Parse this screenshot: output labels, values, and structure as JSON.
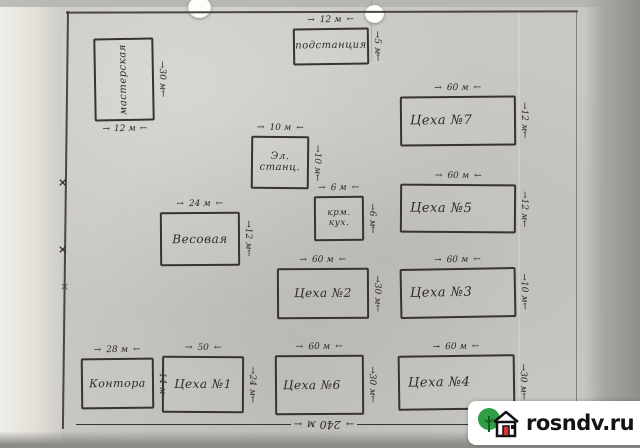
{
  "plan": {
    "buildings": [
      {
        "label": "мастерская",
        "dim_right": "30 м",
        "dim_bottom": "12 м"
      },
      {
        "label": "подстанция",
        "dim_top": "12 м",
        "dim_right": "5 м"
      },
      {
        "label": "Эл. станц.",
        "dim_top": "10 м",
        "dim_right": "10 м"
      },
      {
        "label": "крм. кух.",
        "dim_top": "6 м",
        "dim_right": "6 м"
      },
      {
        "label": "Весовая",
        "dim_top": "24 м",
        "dim_right": "12 м"
      },
      {
        "label": "Цеха №7",
        "dim_top": "60 м",
        "dim_right": "12 м"
      },
      {
        "label": "Цеха №5",
        "dim_top": "60 м",
        "dim_right": "12 м"
      },
      {
        "label": "Цеха №2",
        "dim_top": "60 м",
        "dim_right": "30 м"
      },
      {
        "label": "Цеха №3",
        "dim_top": "60 м",
        "dim_right": "10 м"
      },
      {
        "label": "Контора",
        "dim_top": "28 м",
        "dim_right": "14 м"
      },
      {
        "label": "Цеха №1",
        "dim_top": "50",
        "dim_right": "24 м"
      },
      {
        "label": "Цеха №6",
        "dim_top": "60 м",
        "dim_right": "30 м"
      },
      {
        "label": "Цеха №4",
        "dim_top": "60 м",
        "dim_right": "30 м"
      }
    ],
    "overall_width": "240 м",
    "fence_mark": "×",
    "ink_color": "#37342c",
    "paper_color": "#c8c7c1"
  },
  "watermark": {
    "text": "rosndv.ru",
    "colors": {
      "background": "#ffffff",
      "text": "#141414",
      "tree_green": "#2f9e44",
      "door_red": "#e03131",
      "house_outline": "#111111"
    }
  }
}
